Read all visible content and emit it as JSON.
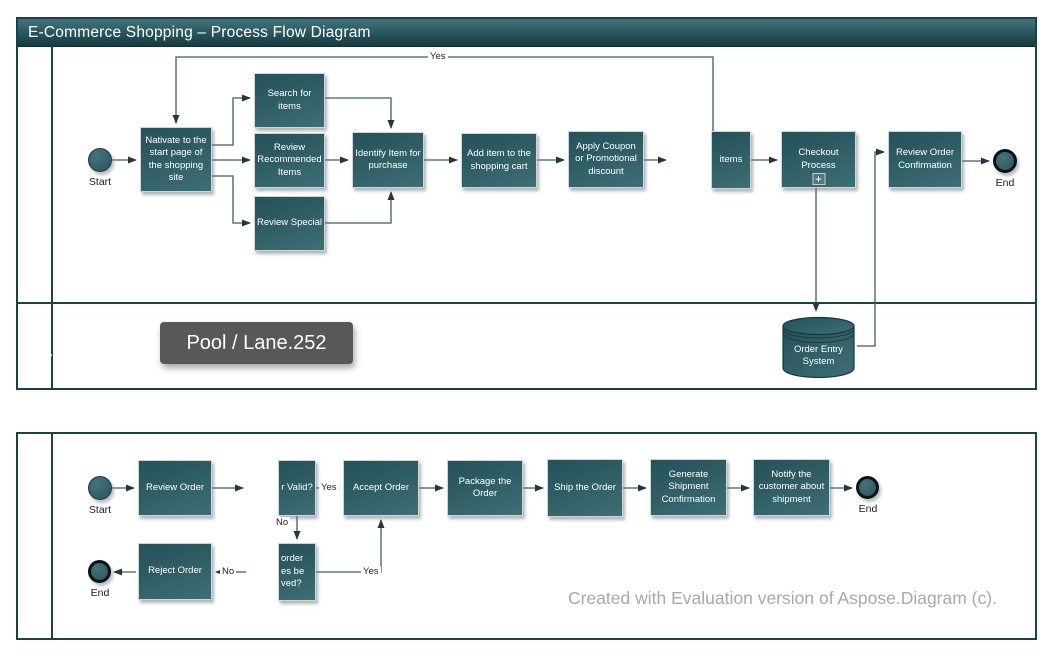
{
  "pool_top": {
    "title": "E-Commerce Shopping – Process Flow Diagram",
    "lane_customer": "Customer",
    "lane_order_entry": "Order Entry\nSystem"
  },
  "pool_bottom": {
    "lane_back_office": "Back Office (Order Fullfillment)"
  },
  "tooltip": {
    "label": "Pool / Lane.252"
  },
  "watermark": {
    "text": "Created with Evaluation version of Aspose.Diagram (c)."
  },
  "nodes": {
    "start_top": {
      "label": "Start"
    },
    "navigate": {
      "label": "Nativate to the start page of the shopping site"
    },
    "search_items": {
      "label": "Search for items"
    },
    "review_recommended": {
      "label": "Review Recommended Items"
    },
    "review_special": {
      "label": "Review Special"
    },
    "identify_item": {
      "label": "Identify Item for purchase"
    },
    "add_item": {
      "label": "Add item to the shopping cart"
    },
    "apply_coupon": {
      "label": "Apply Coupon or Promotional discount"
    },
    "items_clipped": {
      "label": "items"
    },
    "checkout": {
      "label": "Checkout Process",
      "marker": "+"
    },
    "review_order_confirmation": {
      "label": "Review Order Confirmation"
    },
    "end_top": {
      "label": "End"
    },
    "order_entry_db": {
      "label": "Order Entry\nSystem"
    },
    "start_bottom": {
      "label": "Start"
    },
    "review_order": {
      "label": "Review Order"
    },
    "order_valid_clipped": {
      "label": "r Valid?"
    },
    "accept_order": {
      "label": "Accept Order"
    },
    "package_order": {
      "label": "Package the Order"
    },
    "ship_order": {
      "label": "Ship the Order"
    },
    "generate_confirmation": {
      "label": "Generate Shipment Confirmation"
    },
    "notify_customer": {
      "label": "Notify the customer about shipment"
    },
    "end_bottom_right": {
      "label": "End"
    },
    "resolved_clipped": {
      "label": "order\nes be\nved?"
    },
    "reject_order": {
      "label": "Reject Order"
    },
    "end_bottom_left": {
      "label": "End"
    }
  },
  "edge_labels": {
    "yes_top": "Yes",
    "yes_valid": "Yes",
    "no_valid": "No",
    "yes_resolved": "Yes",
    "no_reject": "No"
  },
  "colors": {
    "teal_dark": "#1b4249",
    "box_fill_start": "#26515a",
    "box_fill_end": "#3e6f76",
    "connector": "#3f5e63",
    "tooltip_bg": "#58585a",
    "watermark": "#a9a9a9"
  }
}
